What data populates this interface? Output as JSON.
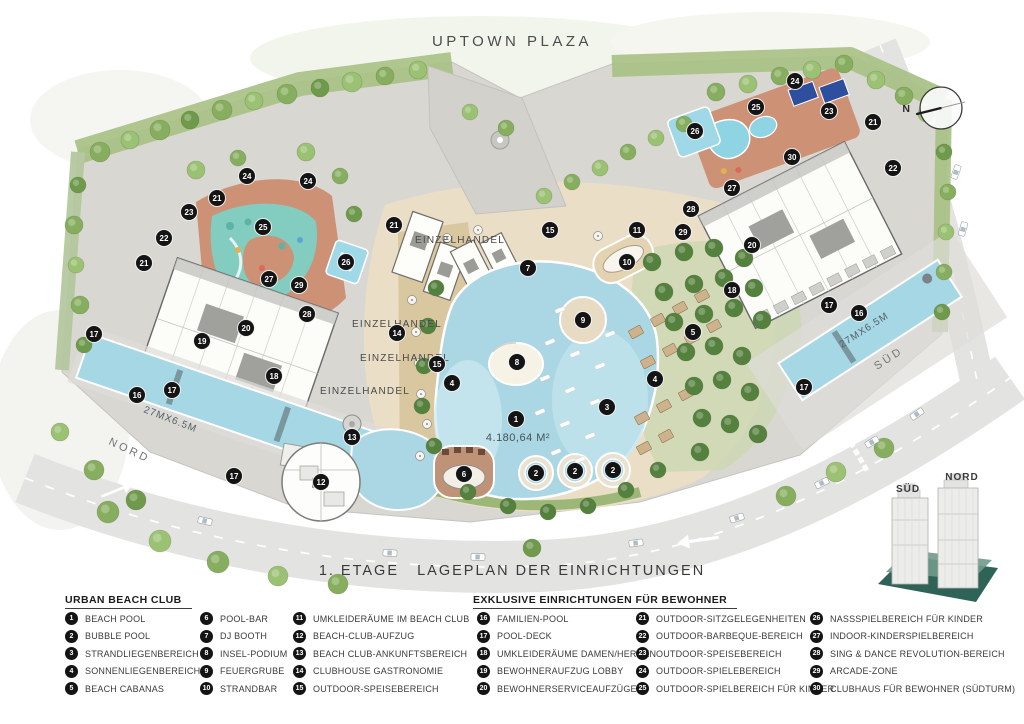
{
  "title": "UPTOWN PLAZA",
  "floor_title": "1. ETAGE   LAGEPLAN DER EINRICHTUNGEN",
  "map": {
    "compass_label": "N",
    "area_label": "4.180,64 M²",
    "retail_labels": [
      "EINZELHANDEL",
      "EINZELHANDEL",
      "EINZELHANDEL",
      "EINZELHANDEL"
    ],
    "pool_dimension_left": "27MX6.5M",
    "pool_dimension_right": "27MX6.5M",
    "road_label_north": "NORD",
    "road_label_south": "SÜD",
    "tower_inset": {
      "south_label": "SÜD",
      "north_label": "NORD"
    },
    "markers": [
      {
        "n": 24,
        "x": 247,
        "y": 176
      },
      {
        "n": 24,
        "x": 308,
        "y": 181
      },
      {
        "n": 21,
        "x": 217,
        "y": 198
      },
      {
        "n": 23,
        "x": 189,
        "y": 212
      },
      {
        "n": 22,
        "x": 164,
        "y": 238
      },
      {
        "n": 21,
        "x": 144,
        "y": 263
      },
      {
        "n": 25,
        "x": 263,
        "y": 227
      },
      {
        "n": 26,
        "x": 346,
        "y": 262
      },
      {
        "n": 27,
        "x": 269,
        "y": 279
      },
      {
        "n": 29,
        "x": 299,
        "y": 285
      },
      {
        "n": 28,
        "x": 307,
        "y": 314
      },
      {
        "n": 20,
        "x": 246,
        "y": 328
      },
      {
        "n": 19,
        "x": 202,
        "y": 341
      },
      {
        "n": 18,
        "x": 274,
        "y": 376
      },
      {
        "n": 17,
        "x": 94,
        "y": 334
      },
      {
        "n": 16,
        "x": 137,
        "y": 395
      },
      {
        "n": 17,
        "x": 172,
        "y": 390
      },
      {
        "n": 17,
        "x": 234,
        "y": 476
      },
      {
        "n": 21,
        "x": 394,
        "y": 225
      },
      {
        "n": 14,
        "x": 397,
        "y": 333
      },
      {
        "n": 15,
        "x": 437,
        "y": 364
      },
      {
        "n": 4,
        "x": 452,
        "y": 383
      },
      {
        "n": 13,
        "x": 352,
        "y": 437
      },
      {
        "n": 12,
        "x": 321,
        "y": 482
      },
      {
        "n": 6,
        "x": 464,
        "y": 474
      },
      {
        "n": 7,
        "x": 528,
        "y": 268
      },
      {
        "n": 8,
        "x": 517,
        "y": 362
      },
      {
        "n": 9,
        "x": 583,
        "y": 320
      },
      {
        "n": 1,
        "x": 516,
        "y": 419
      },
      {
        "n": 3,
        "x": 607,
        "y": 407
      },
      {
        "n": 2,
        "x": 536,
        "y": 473
      },
      {
        "n": 2,
        "x": 575,
        "y": 471
      },
      {
        "n": 2,
        "x": 613,
        "y": 470
      },
      {
        "n": 15,
        "x": 550,
        "y": 230
      },
      {
        "n": 11,
        "x": 637,
        "y": 230
      },
      {
        "n": 10,
        "x": 627,
        "y": 262
      },
      {
        "n": 29,
        "x": 683,
        "y": 232
      },
      {
        "n": 20,
        "x": 752,
        "y": 245
      },
      {
        "n": 18,
        "x": 732,
        "y": 290
      },
      {
        "n": 5,
        "x": 693,
        "y": 332
      },
      {
        "n": 4,
        "x": 655,
        "y": 379
      },
      {
        "n": 26,
        "x": 695,
        "y": 131
      },
      {
        "n": 25,
        "x": 756,
        "y": 107
      },
      {
        "n": 24,
        "x": 795,
        "y": 81
      },
      {
        "n": 23,
        "x": 829,
        "y": 111
      },
      {
        "n": 21,
        "x": 873,
        "y": 122
      },
      {
        "n": 22,
        "x": 893,
        "y": 168
      },
      {
        "n": 30,
        "x": 792,
        "y": 157
      },
      {
        "n": 27,
        "x": 732,
        "y": 188
      },
      {
        "n": 28,
        "x": 691,
        "y": 209
      },
      {
        "n": 17,
        "x": 829,
        "y": 305
      },
      {
        "n": 16,
        "x": 859,
        "y": 313
      },
      {
        "n": 17,
        "x": 804,
        "y": 387
      }
    ]
  },
  "legend": {
    "groups": [
      {
        "heading": "URBAN BEACH CLUB",
        "items": [
          {
            "num": 1,
            "label": "BEACH POOL"
          },
          {
            "num": 2,
            "label": "BUBBLE POOL"
          },
          {
            "num": 3,
            "label": "STRANDLIEGENBEREICH"
          },
          {
            "num": 4,
            "label": "SONNENLIEGENBEREICH"
          },
          {
            "num": 5,
            "label": "BEACH CABANAS"
          },
          {
            "num": 6,
            "label": "POOL-BAR"
          },
          {
            "num": 7,
            "label": "DJ BOOTH"
          },
          {
            "num": 8,
            "label": "INSEL-PODIUM"
          },
          {
            "num": 9,
            "label": "FEUERGRUBE"
          },
          {
            "num": 10,
            "label": "STRANDBAR"
          },
          {
            "num": 11,
            "label": "UMKLEIDERÄUME IM BEACH CLUB"
          },
          {
            "num": 12,
            "label": "BEACH-CLUB-AUFZUG"
          },
          {
            "num": 13,
            "label": "BEACH CLUB-ANKUNFTSBEREICH"
          },
          {
            "num": 14,
            "label": "CLUBHOUSE GASTRONOMIE"
          },
          {
            "num": 15,
            "label": "OUTDOOR-SPEISEBEREICH"
          }
        ]
      },
      {
        "heading": "EXKLUSIVE EINRICHTUNGEN FÜR BEWOHNER",
        "items": [
          {
            "num": 16,
            "label": "FAMILIEN-POOL"
          },
          {
            "num": 17,
            "label": "POOL-DECK"
          },
          {
            "num": 18,
            "label": "UMKLEIDERÄUME DAMEN/HERREN"
          },
          {
            "num": 19,
            "label": "BEWOHNERAUFZUG LOBBY"
          },
          {
            "num": 20,
            "label": "BEWOHNERSERVICEAUFZÜGE"
          },
          {
            "num": 21,
            "label": "OUTDOOR-SITZGELEGENHEITEN"
          },
          {
            "num": 22,
            "label": "OUTDOOR-BARBEQUE-BEREICH"
          },
          {
            "num": 23,
            "label": "OUTDOOR-SPEISEBEREICH"
          },
          {
            "num": 24,
            "label": "OUTDOOR-SPIELEBEREICH"
          },
          {
            "num": 25,
            "label": "OUTDOOR-SPIELBEREICH FÜR KINDER"
          },
          {
            "num": 26,
            "label": "NASSSPIELBEREICH FÜR KINDER"
          },
          {
            "num": 27,
            "label": "INDOOR-KINDERSPIELBEREICH"
          },
          {
            "num": 28,
            "label": "SING & DANCE REVOLUTION-BEREICH"
          },
          {
            "num": 29,
            "label": "ARCADE-ZONE"
          },
          {
            "num": 30,
            "label": "CLUBHAUS FÜR BEWOHNER (SÜDTURM)"
          }
        ]
      }
    ]
  },
  "colors": {
    "water": "#abd7e4",
    "sand": "#ebdec6",
    "greenery": "#87ae5f",
    "playground_terracotta": "#cd9176",
    "splash_teal": "#82ccc0",
    "marker": "#141414",
    "road": "#e3e3e2",
    "podium_teal": "#2f6358"
  }
}
